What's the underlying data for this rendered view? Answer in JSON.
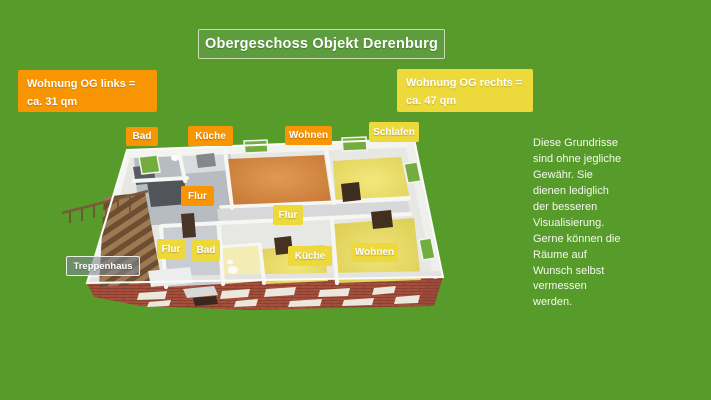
{
  "title": "Obergeschoss Objekt Derenburg",
  "apartments": {
    "left": {
      "line1": "Wohnung OG links =",
      "line2": "ca. 31 qm"
    },
    "right": {
      "line1": "Wohnung OG rechts =",
      "line2": "ca. 47 qm"
    }
  },
  "plan": {
    "labels": [
      {
        "id": "bad-links",
        "text": "Bad",
        "variant": "orange"
      },
      {
        "id": "kueche-links",
        "text": "Küche",
        "variant": "orange"
      },
      {
        "id": "wohnen-links",
        "text": "Wohnen",
        "variant": "orange"
      },
      {
        "id": "schlafen",
        "text": "Schlafen",
        "variant": "yellow"
      },
      {
        "id": "flur-links",
        "text": "Flur",
        "variant": "orange"
      },
      {
        "id": "flur-mitte",
        "text": "Flur",
        "variant": "yellow"
      },
      {
        "id": "flur-unten",
        "text": "Flur",
        "variant": "yellow"
      },
      {
        "id": "bad-unten",
        "text": "Bad",
        "variant": "yellow"
      },
      {
        "id": "kueche-unten",
        "text": "Küche",
        "variant": "yellow"
      },
      {
        "id": "wohnen-unten",
        "text": "Wohnen",
        "variant": "yellow"
      },
      {
        "id": "treppenhaus",
        "text": "Treppenhaus",
        "variant": "gray"
      }
    ]
  },
  "disclaimer": {
    "text": "Diese Grundrisse\nsind ohne jegliche\nGewähr. Sie\ndienen lediglich\nder besseren\nVisualisierung.\nGerne können die\nRäume auf\nWunsch selbst\nvermessen\nwerden."
  },
  "colors": {
    "background": "#579b2a",
    "title_box": "#5d9d3d",
    "accent_orange": "#f79502",
    "accent_yellow": "#eed93c",
    "floor_orange": "#cf8342",
    "floor_yellow": "#ebdf6a",
    "brick": "#a8503c",
    "window_green": "#72ad3e"
  }
}
